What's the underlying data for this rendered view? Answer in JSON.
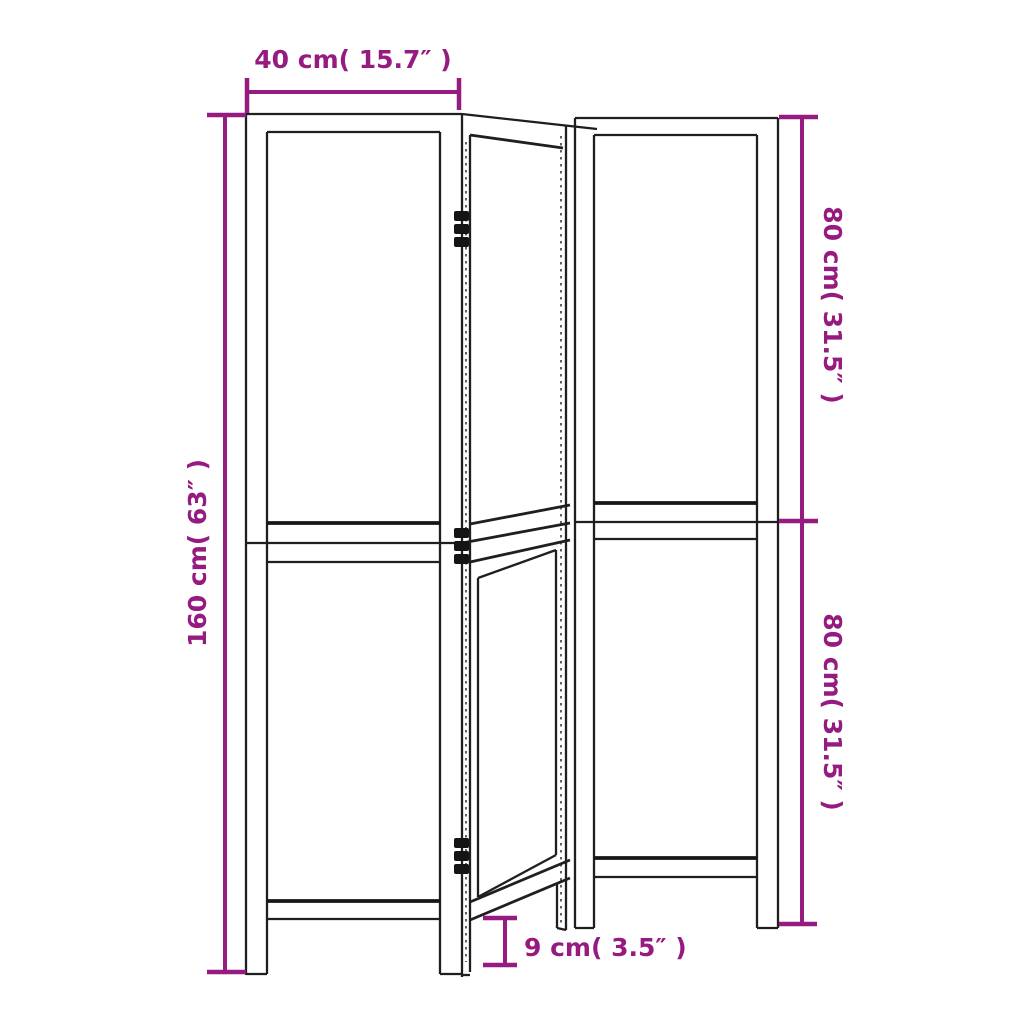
{
  "diagram": {
    "title": "3-panel room divider dimension diagram",
    "panel_count": 3,
    "colors": {
      "dimension_accent": "#951b81",
      "outline": "#1f1f1f",
      "background": "#ffffff"
    },
    "dimensions": {
      "panel_width": {
        "label": "40 cm( 15.7″ )",
        "cm": 40,
        "inch": 15.7
      },
      "total_height": {
        "label": "160 cm( 63″ )",
        "cm": 160,
        "inch": 63
      },
      "upper_section_height": {
        "label": "80 cm( 31.5″ )",
        "cm": 80,
        "inch": 31.5
      },
      "lower_section_height": {
        "label": "80 cm( 31.5″ )",
        "cm": 80,
        "inch": 31.5
      },
      "leg_height": {
        "label": "9 cm( 3.5″ )",
        "cm": 9,
        "inch": 3.5
      }
    }
  }
}
